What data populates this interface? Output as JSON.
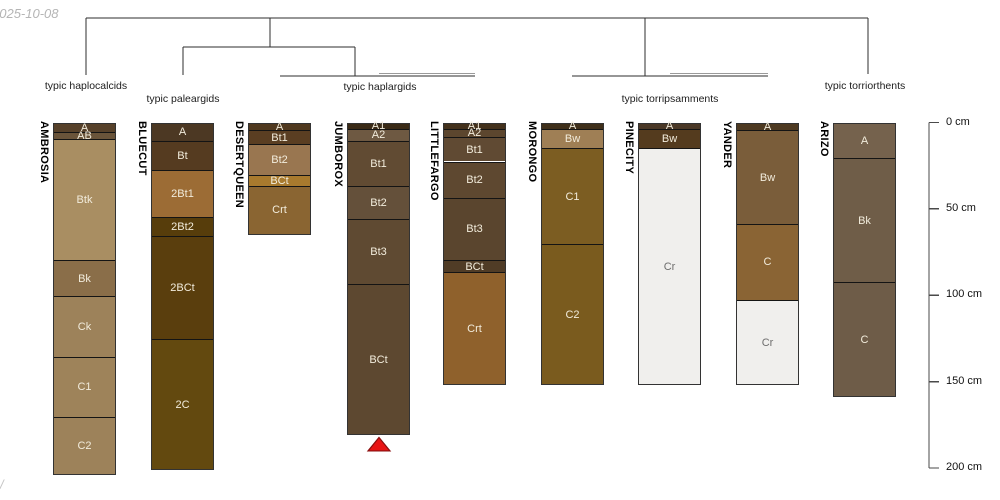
{
  "meta": {
    "date_watermark": "2025-10-08",
    "corner_mark": "/"
  },
  "chart_data": {
    "type": "soil-profile-dendrogram",
    "depth_axis": {
      "unit": "cm",
      "ticks": [
        0,
        50,
        100,
        150,
        200
      ],
      "tick_labels": [
        "0 cm",
        "50 cm",
        "100 cm",
        "150 cm",
        "200 cm"
      ],
      "max_cm": 200
    },
    "groups": [
      {
        "label": "typic haplocalcids",
        "cx": 86,
        "ty": 80
      },
      {
        "label": "typic paleargids",
        "cx": 183,
        "ty": 93
      },
      {
        "label": "typic haplargids",
        "cx": 380,
        "ty": 81
      },
      {
        "label": "typic torripsamments",
        "cx": 670,
        "ty": 93
      },
      {
        "label": "typic torriorthents",
        "cx": 865,
        "ty": 80
      }
    ],
    "dendrogram_segments": [
      {
        "x1": 86,
        "y1": 18,
        "x2": 868,
        "y2": 18
      },
      {
        "x1": 86,
        "y1": 18,
        "x2": 86,
        "y2": 75
      },
      {
        "x1": 270,
        "y1": 18,
        "x2": 270,
        "y2": 47
      },
      {
        "x1": 645,
        "y1": 18,
        "x2": 645,
        "y2": 76
      },
      {
        "x1": 868,
        "y1": 18,
        "x2": 868,
        "y2": 74
      },
      {
        "x1": 183,
        "y1": 47,
        "x2": 355,
        "y2": 47
      },
      {
        "x1": 183,
        "y1": 47,
        "x2": 183,
        "y2": 75
      },
      {
        "x1": 355,
        "y1": 47,
        "x2": 355,
        "y2": 76
      },
      {
        "x1": 280,
        "y1": 76,
        "x2": 475,
        "y2": 76
      },
      {
        "x1": 379,
        "y1": 73.5,
        "x2": 475,
        "y2": 73.5,
        "light": true
      },
      {
        "x1": 572,
        "y1": 76,
        "x2": 768,
        "y2": 76
      },
      {
        "x1": 670,
        "y1": 73.5,
        "x2": 768,
        "y2": 73.5,
        "light": true
      }
    ],
    "profiles": [
      {
        "name": "AMBROSIA",
        "x": 53,
        "horizons": [
          {
            "name": "A",
            "top": 0,
            "bottom": 5,
            "color": "#57412a"
          },
          {
            "name": "AB",
            "top": 5,
            "bottom": 9,
            "color": "#6a543a"
          },
          {
            "name": "Btk",
            "top": 9,
            "bottom": 79,
            "color": "#a98e62"
          },
          {
            "name": "Bk",
            "top": 79,
            "bottom": 100,
            "color": "#8a6e49"
          },
          {
            "name": "Ck",
            "top": 100,
            "bottom": 135,
            "color": "#9d825a"
          },
          {
            "name": "C1",
            "top": 135,
            "bottom": 170,
            "color": "#9e835a"
          },
          {
            "name": "C2",
            "top": 170,
            "bottom": 203,
            "color": "#9d825a"
          }
        ]
      },
      {
        "name": "BLUECUT",
        "x": 151,
        "horizons": [
          {
            "name": "A",
            "top": 0,
            "bottom": 10,
            "color": "#4c3823"
          },
          {
            "name": "Bt",
            "top": 10,
            "bottom": 27,
            "color": "#553b20"
          },
          {
            "name": "2Bt1",
            "top": 27,
            "bottom": 54,
            "color": "#9c6c35"
          },
          {
            "name": "2Bt2",
            "top": 54,
            "bottom": 65,
            "color": "#573d0b"
          },
          {
            "name": "2BCt",
            "top": 65,
            "bottom": 125,
            "color": "#5a3e0d"
          },
          {
            "name": "2C",
            "top": 125,
            "bottom": 200,
            "color": "#63490f"
          }
        ]
      },
      {
        "name": "DESERTQUEEN",
        "x": 248,
        "horizons": [
          {
            "name": "A",
            "top": 0,
            "bottom": 4,
            "color": "#50391f"
          },
          {
            "name": "Bt1",
            "top": 4,
            "bottom": 12,
            "color": "#5a3e22"
          },
          {
            "name": "Bt2",
            "top": 12,
            "bottom": 30,
            "color": "#997650"
          },
          {
            "name": "BCt",
            "top": 30,
            "bottom": 36,
            "color": "#a87a2e"
          },
          {
            "name": "Crt",
            "top": 36,
            "bottom": 64,
            "color": "#8a6532"
          }
        ]
      },
      {
        "name": "JUMBOROX",
        "x": 347,
        "marker": "red-triangle",
        "horizons": [
          {
            "name": "A1",
            "top": 0,
            "bottom": 3,
            "color": "#3a2a16"
          },
          {
            "name": "A2",
            "top": 3,
            "bottom": 10,
            "color": "#6e5942"
          },
          {
            "name": "Bt1",
            "top": 10,
            "bottom": 36,
            "color": "#614b33"
          },
          {
            "name": "Bt2",
            "top": 36,
            "bottom": 55,
            "color": "#64503a"
          },
          {
            "name": "Bt3",
            "top": 55,
            "bottom": 93,
            "color": "#5f4a32"
          },
          {
            "name": "BCt",
            "top": 93,
            "bottom": 180,
            "color": "#5d4830"
          }
        ]
      },
      {
        "name": "LITTLEFARGO",
        "x": 443,
        "horizons": [
          {
            "name": "A1",
            "top": 0,
            "bottom": 3,
            "color": "#43311c"
          },
          {
            "name": "A2",
            "top": 3,
            "bottom": 8,
            "color": "#5c462e"
          },
          {
            "name": "Bt1",
            "top": 8,
            "bottom": 22,
            "color": "#604a33"
          },
          {
            "name": "Bt2",
            "top": 22,
            "bottom": 43,
            "color": "#5e4830"
          },
          {
            "name": "Bt3",
            "top": 43,
            "bottom": 79,
            "color": "#5a452e"
          },
          {
            "name": "BCt",
            "top": 79,
            "bottom": 86,
            "color": "#503c26"
          },
          {
            "name": "Crt",
            "top": 86,
            "bottom": 151,
            "color": "#8f612c"
          }
        ]
      },
      {
        "name": "MORONGO",
        "x": 541,
        "horizons": [
          {
            "name": "A",
            "top": 0,
            "bottom": 3,
            "color": "#3f2f1a"
          },
          {
            "name": "Bw",
            "top": 3,
            "bottom": 14,
            "color": "#9f7f55"
          },
          {
            "name": "C1",
            "top": 14,
            "bottom": 70,
            "color": "#7c5d22"
          },
          {
            "name": "C2",
            "top": 70,
            "bottom": 151,
            "color": "#7a5b1e"
          }
        ]
      },
      {
        "name": "PINECITY",
        "x": 638,
        "horizons": [
          {
            "name": "A",
            "top": 0,
            "bottom": 3,
            "color": "#4a3826"
          },
          {
            "name": "Bw",
            "top": 3,
            "bottom": 14,
            "color": "#543b1e"
          },
          {
            "name": "Cr",
            "top": 14,
            "bottom": 151,
            "color": "#f0efed",
            "text_color": "#6e6e6e"
          }
        ]
      },
      {
        "name": "YANDER",
        "x": 736,
        "horizons": [
          {
            "name": "A",
            "top": 0,
            "bottom": 4,
            "color": "#4e3a22"
          },
          {
            "name": "Bw",
            "top": 4,
            "bottom": 58,
            "color": "#7a5d3a"
          },
          {
            "name": "C",
            "top": 58,
            "bottom": 102,
            "color": "#8a6434"
          },
          {
            "name": "Cr",
            "top": 102,
            "bottom": 151,
            "color": "#f0efed",
            "text_color": "#6e6e6e"
          }
        ]
      },
      {
        "name": "ARIZO",
        "x": 833,
        "horizons": [
          {
            "name": "A",
            "top": 0,
            "bottom": 20,
            "color": "#75624d"
          },
          {
            "name": "Bk",
            "top": 20,
            "bottom": 92,
            "color": "#6f5d48"
          },
          {
            "name": "C",
            "top": 92,
            "bottom": 158,
            "color": "#6e5c48"
          }
        ]
      }
    ],
    "marker": {
      "shape": "triangle",
      "fill": "#e81414",
      "edge": "#8a0f0f",
      "profile": "JUMBOROX"
    },
    "style": {
      "horizon_label_color": "#f2ecdc",
      "dendrogram_color": "#2d2d2d",
      "dendrogram_light_color": "#9a9a9a",
      "axis_color": "#4a4a4a"
    }
  }
}
